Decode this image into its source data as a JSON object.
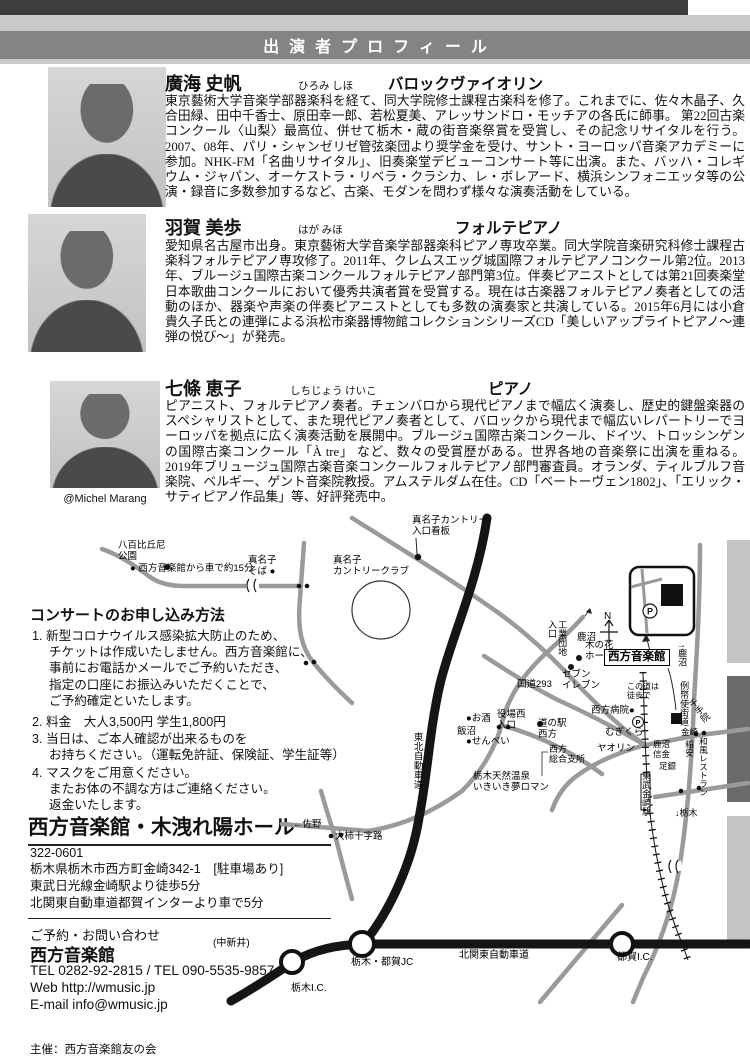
{
  "header": {
    "title": "出演者プロフィール"
  },
  "performers": [
    {
      "name": "廣海 史帆",
      "furigana": "ひろみ しほ",
      "instrument": "バロックヴァイオリン",
      "bio": "東京藝術大学音楽学部器楽科を経て、同大学院修士課程古楽科を修了。これまでに、佐々木晶子、久合田緑、田中千香士、原田幸一郎、若松夏美、アレッサンドロ・モッチアの各氏に師事。 第22回古楽コンクール〈山梨〉最高位、併せて栃木・蔵の街音楽祭賞を受賞し、その記念リサイタルを行う。2007、08年、パリ・シャンゼリゼ管弦楽団より奨学金を受け、サント・ヨーロッパ音楽アカデミーに参加。NHK-FM「名曲リサイタル」、旧奏楽堂デビューコンサート等に出演。また、バッハ・コレギウム・ジャパン、オーケストラ・リベラ・クラシカ、レ・ボレアード、横浜シンフォニエッタ等の公演・録音に多数参加するなど、古楽、モダンを問わず様々な演奏活動をしている。"
    },
    {
      "name": "羽賀 美歩",
      "furigana": "はが みほ",
      "instrument": "フォルテピアノ",
      "bio": "愛知県名古屋市出身。東京藝術大学音楽学部器楽科ピアノ専攻卒業。同大学院音楽研究科修士課程古楽科フォルテピアノ専攻修了。2011年、クレムスエッグ城国際フォルテピアノコンクール第2位。2013年、ブルージュ国際古楽コンクールフォルテピアノ部門第3位。伴奏ピアニストとしては第21回奏楽堂日本歌曲コンクールにおいて優秀共演者賞を受賞する。現在は古楽器フォルテピアノ奏者としての活動のほか、器楽や声楽の伴奏ピアニストとしても多数の演奏家と共演している。2015年6月には小倉貴久子氏との連弾による浜松市楽器博物館コレクションシリーズCD「美しいアップライトピアノ～連弾の悦び～」が発売。"
    },
    {
      "name": "七條 恵子",
      "furigana": "しちじょう けいこ",
      "instrument": "ピアノ",
      "photo_credit": "@Michel Marang",
      "bio": "ピアニスト、フォルテピアノ奏者。チェンバロから現代ピアノまで幅広く演奏し、歴史的鍵盤楽器のスペシャリストとして、また現代ピアノ奏者として、バロックから現代まで幅広いレパートリーでヨーロッパを拠点に広く演奏活動を展開中。ブルージュ国際古楽コンクール、ドイツ、トロッシンゲンの国際古楽コンクール「À tre」 など、数々の受賞歴がある。世界各地の音楽祭に出演を重ねる。 2019年ブリュージュ国際古楽音楽コンクールフォルテピアノ部門審査員。オランダ、ティルブルフ音楽院、ベルギー、ゲント音楽院教授。アムステルダム在住。CD「ベートーヴェン1802」、「エリック・サティピアノ作品集」等、好評発売中。"
    }
  ],
  "application": {
    "title": "コンサートのお申し込み方法",
    "items": [
      "1. 新型コロナウイルス感染拡大防止のため、\nチケットは作成いたしません。西方音楽館に、\n事前にお電話かメールでご予約いただき、\n指定の口座にお振込みいただくことで、\nご予約確定といたします。",
      "2. 料金　大人3,500円 学生1,800円",
      "3. 当日は、ご本人確認が出来るものを\nお持ちください。（運転免許証、保険証、学生証等）",
      "4. マスクをご用意ください。\nまたお体の不調な方はご連絡ください。\n返金いたします。"
    ]
  },
  "venue": {
    "name": "西方音楽館・木洩れ陽ホール",
    "postal": "322-0601",
    "address": "栃木県栃木市西方町金崎342-1　[駐車場あり]\n東武日光線金崎駅より徒歩5分\n北関東自動車道都賀インターより車で5分"
  },
  "contact": {
    "label": "ご予約・お問い合わせ",
    "name": "西方音楽館",
    "tel": "TEL 0282-92-2815 / TEL 090-5535-9857",
    "web": "Web  http://wmusic.jp\nE-mail  info@wmusic.jp"
  },
  "footer": {
    "organizer": "主催：西方音楽館友の会"
  },
  "colors": {
    "header_dark": "#3d3d3d",
    "header_light": "#c9c9c9",
    "title_band": "#848484",
    "edge_light": "#c4c4c4",
    "edge_dark": "#6b6b6b",
    "road_gray": "#9a9a9a",
    "road_black": "#151515"
  },
  "map": {
    "labels": [
      {
        "t": "八百比丘尼\n公園",
        "x": 118,
        "y": 541,
        "n": "map-label-park"
      },
      {
        "t": "● 西方音楽館から車で約15分",
        "x": 130,
        "y": 564,
        "n": "map-label-drive-time"
      },
      {
        "t": "真名子\nそば ●",
        "x": 248,
        "y": 556,
        "n": "map-label-manago-soba"
      },
      {
        "t": "真名子カントリー\n入口看板",
        "x": 412,
        "y": 516,
        "n": "map-label-country-sign"
      },
      {
        "t": "真名子\nカントリークラブ",
        "x": 333,
        "y": 556,
        "n": "map-label-country-club"
      },
      {
        "t": "N",
        "x": 604,
        "y": 611,
        "s": 10,
        "n": "map-label-north"
      },
      {
        "t": "鹿沼",
        "x": 577,
        "y": 633,
        "n": "map-label-kanuma-top"
      },
      {
        "t": "工業団地\n入口",
        "x": 547,
        "y": 620,
        "s": 9,
        "v": 1,
        "n": "map-label-kogyodanchi"
      },
      {
        "t": "木の花\nホーム",
        "x": 585,
        "y": 641,
        "n": "map-label-konohana-home"
      },
      {
        "t": "セブン\nイレブン",
        "x": 562,
        "y": 670,
        "n": "map-label-seven-eleven"
      },
      {
        "t": "国道293",
        "x": 517,
        "y": 680,
        "n": "map-label-route-293"
      },
      {
        "t": "役場西\n入口",
        "x": 497,
        "y": 710,
        "n": "map-label-yakuba-nishi"
      },
      {
        "t": "●お酒",
        "x": 466,
        "y": 714,
        "n": "map-label-osake"
      },
      {
        "t": "飯沼",
        "x": 457,
        "y": 727,
        "n": "map-label-iinuma"
      },
      {
        "t": "●せんべい",
        "x": 466,
        "y": 737,
        "n": "map-label-senbei"
      },
      {
        "t": "東北自動車道",
        "x": 411,
        "y": 732,
        "v": 1,
        "n": "map-label-tohoku-expwy"
      },
      {
        "t": "道の駅\n西方",
        "x": 538,
        "y": 719,
        "n": "map-label-michinoeki"
      },
      {
        "t": "西方\n総合支所",
        "x": 549,
        "y": 744,
        "s": 9,
        "n": "map-label-shisho"
      },
      {
        "t": "栃木天然温泉\nいきいき夢ロマン",
        "x": 473,
        "y": 772,
        "n": "map-label-onsen"
      },
      {
        "t": "西方病院●",
        "x": 591,
        "y": 706,
        "n": "map-label-hospital"
      },
      {
        "t": "この道は\n徒歩で",
        "x": 627,
        "y": 683,
        "s": 8,
        "n": "map-label-walk-road"
      },
      {
        "t": "むぎくら",
        "x": 605,
        "y": 728,
        "n": "map-label-mugikura"
      },
      {
        "t": "ヤオリン",
        "x": 597,
        "y": 744,
        "n": "map-label-yaorin"
      },
      {
        "t": "例幣使街道",
        "x": 679,
        "y": 681,
        "s": 9,
        "v": 1,
        "n": "map-label-reiheishi-kaido"
      },
      {
        "t": "千手院",
        "x": 694,
        "y": 697,
        "s": 9,
        "v": 1,
        "r": -38,
        "n": "map-label-senjuin"
      },
      {
        "t": "金崎",
        "x": 681,
        "y": 728,
        "s": 8.5,
        "n": "map-label-kanasaki"
      },
      {
        "t": "鹿沼\n信金",
        "x": 653,
        "y": 740,
        "s": 8.5,
        "n": "map-label-shinkin"
      },
      {
        "t": "稲安",
        "x": 684,
        "y": 740,
        "s": 8.5,
        "v": 1,
        "n": "map-label-inayasu"
      },
      {
        "t": "和風レストラン",
        "x": 698,
        "y": 737,
        "s": 8.5,
        "v": 1,
        "n": "map-label-restaurant"
      },
      {
        "t": "足銀",
        "x": 659,
        "y": 762,
        "s": 8.5,
        "n": "map-label-bank"
      },
      {
        "t": "東武金崎駅",
        "x": 641,
        "y": 771,
        "s": 9,
        "v": 1,
        "n": "map-label-kanasaki-station"
      },
      {
        "t": "↑鹿沼",
        "x": 677,
        "y": 644,
        "s": 9,
        "v": 1,
        "n": "map-label-kanuma-arrow"
      },
      {
        "t": "↓栃木",
        "x": 675,
        "y": 808,
        "s": 9,
        "n": "map-label-tochigi-arrow"
      },
      {
        "t": "←佐野",
        "x": 293,
        "y": 820,
        "n": "map-label-sano"
      },
      {
        "t": "大柿十字路",
        "x": 335,
        "y": 832,
        "n": "map-label-ogaki-crossing"
      },
      {
        "t": "(中新井)",
        "x": 213,
        "y": 938,
        "s": 10,
        "n": "map-label-nakaarai"
      },
      {
        "t": "栃木I.C.",
        "x": 291,
        "y": 983,
        "s": 10,
        "n": "map-label-tochigi-ic"
      },
      {
        "t": "栃木・都賀JC",
        "x": 351,
        "y": 957,
        "s": 10,
        "n": "map-label-tsuga-jc"
      },
      {
        "t": "北関東自動車道",
        "x": 459,
        "y": 950,
        "s": 10,
        "n": "map-label-kitakanto-expwy"
      },
      {
        "t": "都賀I.C.",
        "x": 617,
        "y": 952,
        "s": 10,
        "n": "map-label-tsuga-ic"
      },
      {
        "t": "西方音楽館",
        "x": 604,
        "y": 649,
        "s": 11.5,
        "box": 1,
        "n": "map-label-venue"
      }
    ]
  }
}
